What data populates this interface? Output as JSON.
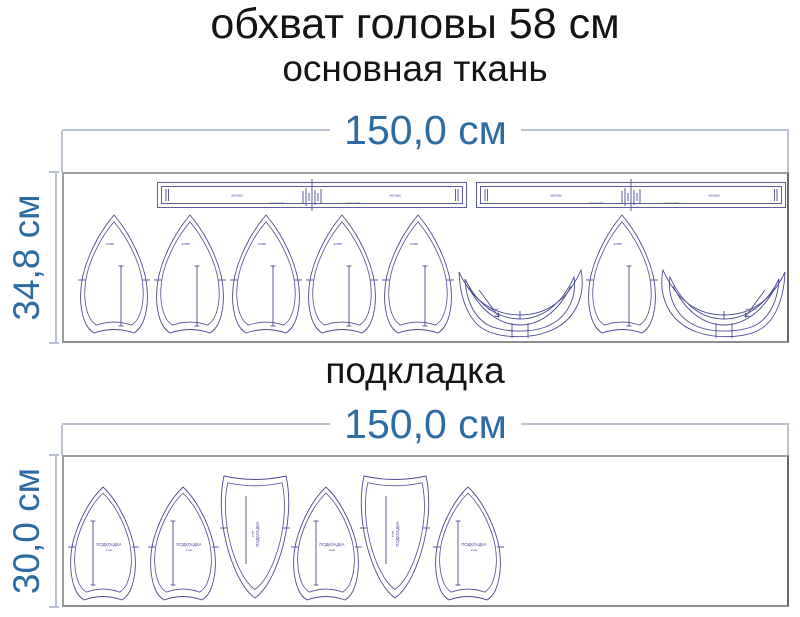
{
  "header": {
    "title": "обхват головы 58 см"
  },
  "sections": {
    "main": {
      "name": "основная ткань",
      "width_label": "150,0 см",
      "height_label": "34,8 см"
    },
    "lining": {
      "name": "подкладка",
      "width_label": "150,0 см",
      "height_label": "30,0 см"
    }
  },
  "piece_labels": {
    "wedge": "клин",
    "visor": "козырек",
    "band_left": "околыш",
    "band_right": "околыш",
    "band_sub_left": "линия сгиба",
    "band_sub_right": "линия сгиба",
    "lining_name": "ПОДКЛАДКА",
    "lining_part": "клин"
  },
  "colors": {
    "dimension": "#2d6ca3",
    "dimension_line": "#b9c2d0",
    "outline": "#4a4a94",
    "frame": "#9e9e9e",
    "text": "#141414"
  }
}
